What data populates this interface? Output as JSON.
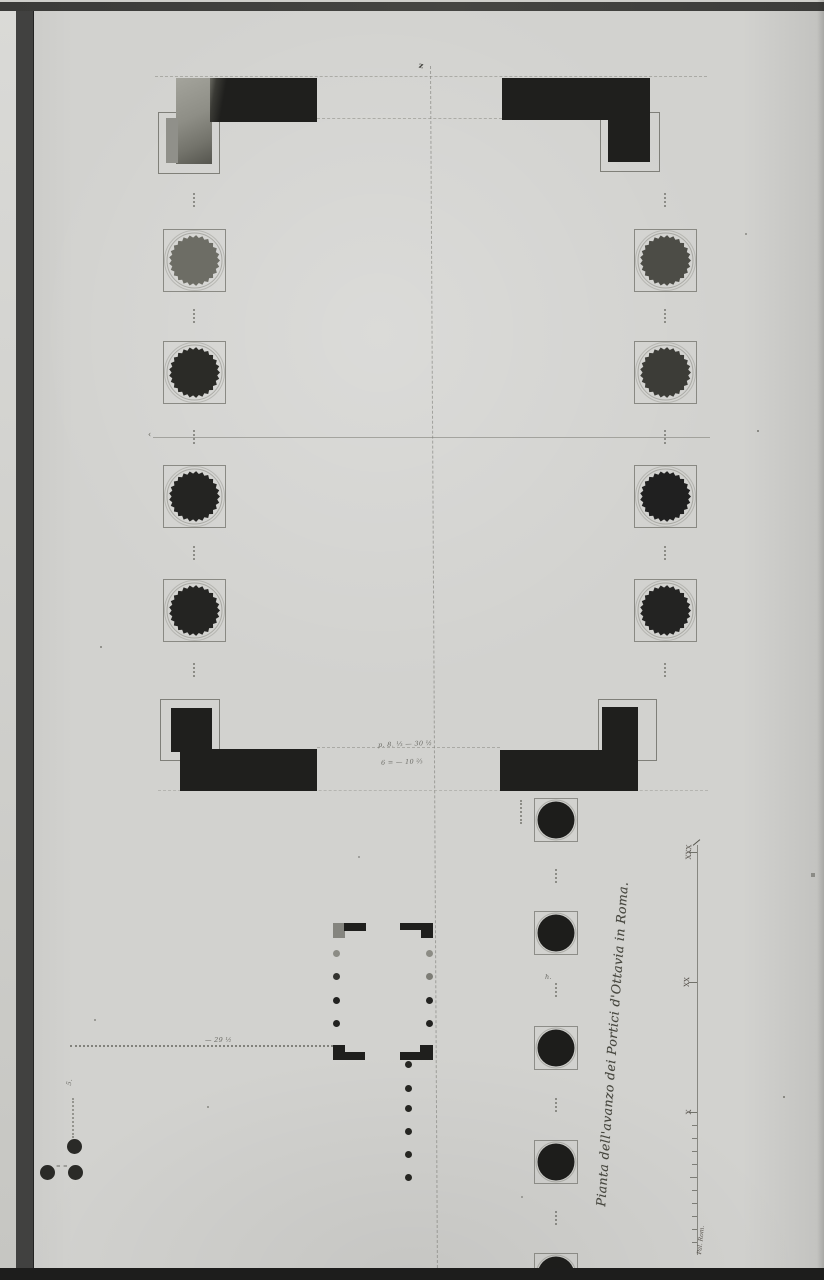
{
  "title": {
    "text": "Pianta dell'avanzo dei Portici d'Ottavia in Roma."
  },
  "scale_bar": {
    "label_30": "XXX",
    "label_20": "XX",
    "label_10": "X",
    "unit_label": "Pal. Rom."
  },
  "annotations": {
    "dim_top": "p. 8. ⅓ — 30 ½",
    "dim_bottom": "6 = — 10 ⅔",
    "dim_left": "— 29 ½",
    "h_mark": "h.",
    "eq_marks": "= =",
    "squiggle": "5.",
    "arrow_left": "‹",
    "north_mark": "z"
  },
  "colors": {
    "paper": "#d2d2cf",
    "ink": "#1f1f1d",
    "faded_ink": "#6d6d65",
    "construction_line": "#8d8d85",
    "frame_dark": "#3e3e3c",
    "frame_light": "#d8d8d5",
    "title_ink": "#45453d"
  },
  "plan": {
    "main_colonnade": {
      "square": 63,
      "gear": 51,
      "left_x": 194,
      "right_x": 665,
      "rows": [
        260,
        372,
        496,
        610
      ],
      "left_fills": [
        "#6d6d65",
        "#2b2b27",
        "#242422",
        "#242422"
      ],
      "right_fills": [
        "#4c4c46",
        "#3c3c37",
        "#202020",
        "#232322"
      ],
      "axis_dot_centers": [
        200,
        316,
        437,
        553,
        670
      ]
    },
    "lower_colonnade": {
      "x": 556,
      "square": 44,
      "circle": 37,
      "rows": [
        820,
        933,
        1048,
        1162,
        1275
      ],
      "fill": "#1d1d1b",
      "axis_dot_centers": [
        876,
        990,
        1105,
        1218
      ]
    },
    "key_plan": {
      "corners": [
        {
          "rects": [
            [
              333,
              923,
              12,
              15
            ],
            [
              344,
              923,
              22,
              8
            ]
          ],
          "gray_first": true
        },
        {
          "rects": [
            [
              421,
              923,
              12,
              15
            ],
            [
              400,
              923,
              22,
              7
            ]
          ]
        },
        {
          "rects": [
            [
              333,
              1045,
              12,
              15
            ],
            [
              345,
              1052,
              20,
              8
            ]
          ]
        },
        {
          "rects": [
            [
              420,
              1045,
              13,
              15
            ],
            [
              400,
              1052,
              20,
              8
            ]
          ]
        }
      ],
      "left_dots": {
        "x": 336,
        "rows": [
          953,
          976,
          1000,
          1023
        ],
        "fills": [
          "#8c8c85",
          "#33332f",
          "#222220",
          "#222220"
        ],
        "d": 7
      },
      "right_dots": {
        "x": 429,
        "rows": [
          953,
          976,
          1000,
          1023
        ],
        "fills": [
          "#8c8c85",
          "#7d7d76",
          "#242422",
          "#222220"
        ],
        "d": 7
      },
      "lead_dots": {
        "x": 408,
        "rows": [
          1064,
          1088,
          1108,
          1131,
          1154,
          1177
        ],
        "fill": "#262622",
        "d": 7
      }
    },
    "survey_dots": {
      "d": 15,
      "fill": "#2a2a27",
      "points": [
        [
          74,
          1146
        ],
        [
          47,
          1172
        ],
        [
          75,
          1172
        ]
      ]
    },
    "scale_ticks": {
      "x": 697,
      "major_rows": [
        852,
        982,
        1112
      ],
      "unit_top": 1125,
      "unit_step": 13,
      "unit_count": 10
    }
  }
}
